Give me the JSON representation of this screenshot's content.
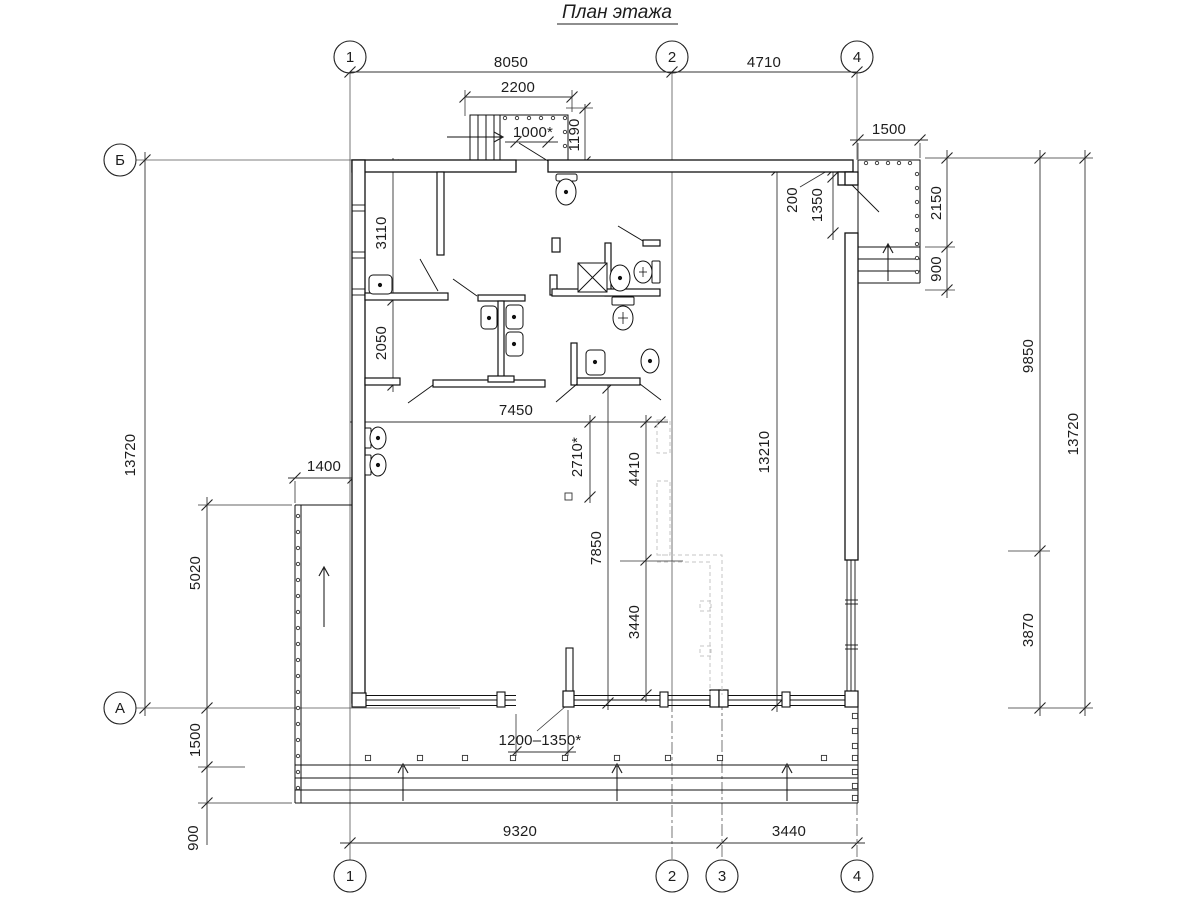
{
  "title": "План этажа",
  "axis_markers": {
    "top": [
      "1",
      "2",
      "4"
    ],
    "bottom": [
      "1",
      "2",
      "3",
      "4"
    ],
    "left": [
      "Б",
      "А"
    ]
  },
  "dimensions": {
    "top_8050": "8050",
    "top_4710": "4710",
    "entry_2200": "2200",
    "entry_1000": "1000*",
    "entry_1190": "1190",
    "porch_1500": "1500",
    "wall_200": "200",
    "wall_1350": "1350",
    "porch_2150": "2150",
    "porch_900": "900",
    "right_9850": "9850",
    "right_3870": "3870",
    "right_13720": "13720",
    "left_13720": "13720",
    "left_5020": "5020",
    "left_1500": "1500",
    "left_900": "900",
    "left_1400": "1400",
    "room_3110": "3110",
    "room_2050": "2050",
    "hall_7450": "7450",
    "hall_2710": "2710*",
    "hall_7850": "7850",
    "hall_4410": "4410",
    "hall_3440": "3440",
    "hall_13210": "13210",
    "opening_1200_1350": "1200–1350*",
    "bottom_9320": "9320",
    "bottom_3440": "3440"
  }
}
